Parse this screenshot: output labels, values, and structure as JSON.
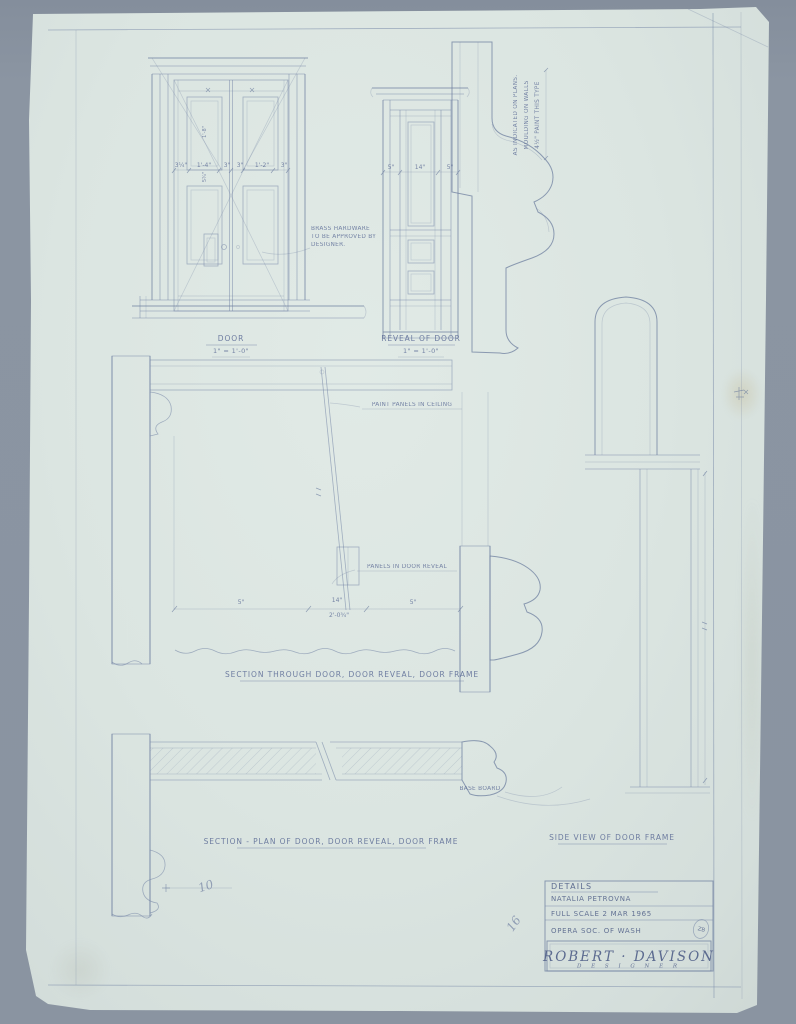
{
  "palette": {
    "backdrop_gray": "#8a94a1",
    "paper_blue_green": "#dbe5e1",
    "pencil_graphite": "#7787a6"
  },
  "drawings": {
    "door_elevation": {
      "label": "DOOR",
      "scale": "1\" = 1'-0\"",
      "dims": [
        "3¼\"",
        "1'-4\"",
        "3\"",
        "3\"",
        "1'-2\"",
        "3\""
      ],
      "panel_dim_height": "1'-8\"",
      "panel_dim_gap": "5¾\"",
      "hardware_note": [
        "BRASS HARDWARE",
        "TO BE APPROVED BY",
        "DESIGNER."
      ]
    },
    "reveal_elevation": {
      "label": "REVEAL OF DOOR",
      "scale": "1\" = 1'-0\"",
      "dims": [
        "5\"",
        "14\"",
        "5\""
      ]
    },
    "frame_profile": {
      "note": [
        "4½\"  PAINT THIS TYPE",
        "MOULDING ON WALLS",
        "AS INDICATED ON PLANS."
      ]
    },
    "section": {
      "label": "SECTION THROUGH DOOR, DOOR REVEAL, DOOR FRAME",
      "note_ceiling": "PAINT PANELS IN CEILING",
      "note_reveal": "PANELS IN DOOR REVEAL",
      "dims": [
        "5\"",
        "14\"",
        "2'-0¾\"",
        "5\""
      ]
    },
    "side_view": {
      "label": "SIDE VIEW OF DOOR FRAME"
    },
    "plan_section": {
      "label": "SECTION - PLAN OF DOOR, DOOR REVEAL, DOOR FRAME",
      "note_baseboard": "BASE BOARD"
    },
    "detail_mark": "10",
    "pencil_scribble": "16"
  },
  "title_block": {
    "title": "DETAILS",
    "project": "NATALIA PETROVNA",
    "scale_line": "FULL SCALE  2 MAR 1965",
    "client_line": "OPERA SOC. OF WASH",
    "stamp": "ZB",
    "designer_name": "ROBERT · DAVISON",
    "designer_role": "D E S I G N E R"
  }
}
